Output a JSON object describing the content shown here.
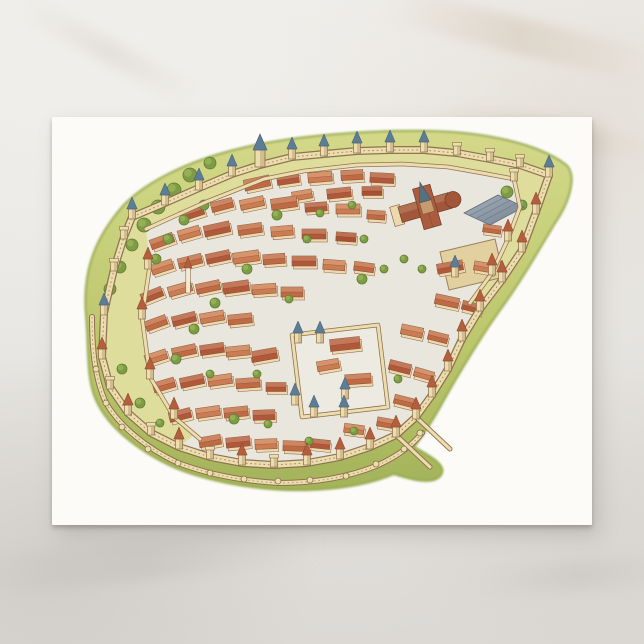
{
  "scene": {
    "description": "White postcard lying on a pale marble surface; the postcard bears a watercolor aerial illustration of a medieval walled city with towers, red-roofed houses, a cathedral and a castle",
    "signature": {
      "text": "E.",
      "x": 313,
      "y": 333
    }
  },
  "palette": {
    "postcard": "#fcfbf8",
    "street": "#e9e6dd",
    "lists": "#dcdc96",
    "grass1": "#d2d884",
    "grass2": "#b9c465",
    "grass3": "#9fb052",
    "grassEdge": "#8ea23e",
    "wallFill": "#ecdcae",
    "wallLine": "#8a6f4c",
    "houseWall": "#ecd9ad",
    "houseLine": "#8a5638",
    "roof0": "#bf6a45",
    "roof1": "#b2583a",
    "roof2": "#cb7c52",
    "roof3": "#a94f33",
    "blueRoof": "#5d7d97",
    "blueRoofDark": "#3f5a70",
    "redCone": "#b35f3d",
    "redConeDark": "#8a4228",
    "tree": "#7e9c44",
    "treeDark": "#5f7d33",
    "treeLight": "#96b458",
    "hallRib": "#6e7c89",
    "hallEdge": "#5f6d7a",
    "churchRoof": "#a2573a",
    "churchDark": "#6f3a26",
    "yard": "#e3cf9e",
    "yardLine": "#9a7c52",
    "spire": "#55707f",
    "signature": "#7a6a50",
    "castleFloor": "#edeae1"
  },
  "city": {
    "grassPath": "M34,198 C30,150 46,118 70,90 C94,64 138,44 182,33 C228,21 300,13 376,14 C434,15 486,27 513,47 C526,57 518,84 503,106 C488,131 470,163 448,193 C430,218 412,248 397,274 C386,294 376,312 362,330 C376,338 396,348 389,358 C381,369 358,362 342,357 C318,367 288,372 256,373 C213,374 165,367 126,352 C93,338 57,313 44,283 C34,261 37,229 34,198 Z",
    "ringPath": "M52,196 L62,152 L72,120 L80,100 L113,86 L147,71 L180,57 L208,48 L240,40 L272,37 L305,34 L338,33 L372,33 L405,36 L438,42 L468,48 L497,58 L484,95 L470,133 L450,163 L428,192 L410,222 L396,252 L380,278 L364,300 L344,318 L318,330 L288,340 L255,346 L222,348 L190,346 L158,340 L127,330 L99,316 L76,296 L58,270 L50,240 Z",
    "topBand": "M80,100 L113,86 L147,71 L180,57 L208,48 L240,40 L272,37 L305,34 L338,33 L372,33 L405,36 L438,42 L468,48 L462,62 L430,56 L396,50 L350,47 L305,48 L252,54 L212,62 L154,85 L94,112 Z",
    "eBand": "M468,48 L497,58 L484,95 L470,133 L450,163 L428,192 L418,186 L440,156 L456,122 L468,90 L462,62 Z",
    "wBand": "M52,196 L62,152 L72,120 L80,100 L94,112 L98,148 L90,200 L98,260 L122,300 L142,318 L127,330 L99,316 L76,296 L58,270 L50,240 Z",
    "innerTop": "M94,112 L154,85 L212,62 L252,54 L305,48 L350,47 L396,50 L430,56 L462,62",
    "innerE": "M462,62 L468,90 L456,122 L440,156 L418,186",
    "innerW": "M98,148 L90,200 L98,260 L122,300 L148,322",
    "outerSW": "M40,200 C40,238 44,264 54,286 C68,310 96,332 126,346 C158,358 192,364 226,366 C260,366 294,361 324,349 C342,341 358,331 370,316",
    "spurs": [
      "M364,300 L398,332",
      "M344,318 L378,350"
    ],
    "nubs": [
      [
        44,
        252
      ],
      [
        54,
        286
      ],
      [
        70,
        310
      ],
      [
        96,
        332
      ],
      [
        126,
        346
      ],
      [
        158,
        356
      ],
      [
        192,
        362
      ],
      [
        226,
        364
      ],
      [
        258,
        363
      ],
      [
        294,
        359
      ],
      [
        324,
        347
      ],
      [
        352,
        332
      ],
      [
        368,
        316
      ]
    ],
    "towers": [
      [
        52,
        196,
        "b"
      ],
      [
        62,
        152,
        "p"
      ],
      [
        72,
        120,
        "p"
      ],
      [
        80,
        100,
        "b"
      ],
      [
        113,
        86,
        "b"
      ],
      [
        147,
        71,
        "b"
      ],
      [
        180,
        57,
        "b"
      ],
      [
        208,
        48,
        "t"
      ],
      [
        240,
        40,
        "b"
      ],
      [
        272,
        37,
        "b"
      ],
      [
        305,
        34,
        "b"
      ],
      [
        338,
        33,
        "b"
      ],
      [
        372,
        33,
        "b"
      ],
      [
        405,
        36,
        "p"
      ],
      [
        438,
        42,
        "p"
      ],
      [
        468,
        48,
        "p"
      ],
      [
        497,
        58,
        "b"
      ],
      [
        484,
        95,
        "r"
      ],
      [
        470,
        133,
        "r"
      ],
      [
        450,
        163,
        "r"
      ],
      [
        428,
        192,
        "r"
      ],
      [
        403,
        158,
        "b"
      ],
      [
        410,
        222,
        "r"
      ],
      [
        396,
        252,
        "r"
      ],
      [
        380,
        278,
        "r"
      ],
      [
        364,
        300,
        "r"
      ],
      [
        344,
        318,
        "r"
      ],
      [
        318,
        330,
        "r"
      ],
      [
        288,
        340,
        "r"
      ],
      [
        255,
        346,
        "r"
      ],
      [
        222,
        348,
        "p"
      ],
      [
        190,
        346,
        "r"
      ],
      [
        158,
        340,
        "p"
      ],
      [
        127,
        330,
        "r"
      ],
      [
        99,
        316,
        "p"
      ],
      [
        76,
        296,
        "r"
      ],
      [
        58,
        270,
        "p"
      ],
      [
        50,
        240,
        "r"
      ],
      [
        96,
        150,
        "r"
      ],
      [
        90,
        200,
        "r"
      ],
      [
        98,
        260,
        "r"
      ],
      [
        122,
        300,
        "r"
      ],
      [
        462,
        62,
        "p"
      ],
      [
        456,
        122,
        "r"
      ],
      [
        440,
        156,
        "r"
      ]
    ],
    "houses": [
      [
        205,
        66,
        26,
        11,
        -12,
        0
      ],
      [
        236,
        62,
        22,
        10,
        -8,
        1
      ],
      [
        268,
        60,
        24,
        10,
        -5,
        2
      ],
      [
        300,
        58,
        22,
        10,
        -3,
        0
      ],
      [
        330,
        61,
        24,
        10,
        3,
        1
      ],
      [
        250,
        78,
        20,
        9,
        -10,
        2
      ],
      [
        287,
        76,
        24,
        10,
        -6,
        1
      ],
      [
        320,
        74,
        20,
        9,
        0,
        3
      ],
      [
        140,
        96,
        24,
        10,
        -18,
        1
      ],
      [
        170,
        88,
        22,
        10,
        -15,
        0
      ],
      [
        200,
        86,
        24,
        10,
        -12,
        2
      ],
      [
        232,
        86,
        26,
        11,
        -8,
        0
      ],
      [
        264,
        90,
        22,
        9,
        -4,
        1
      ],
      [
        296,
        92,
        24,
        10,
        0,
        2
      ],
      [
        324,
        98,
        18,
        9,
        4,
        0
      ],
      [
        110,
        124,
        24,
        10,
        -20,
        0
      ],
      [
        137,
        116,
        22,
        10,
        -16,
        2
      ],
      [
        165,
        112,
        26,
        11,
        -12,
        1
      ],
      [
        198,
        112,
        24,
        10,
        -8,
        0
      ],
      [
        230,
        114,
        22,
        10,
        -5,
        2
      ],
      [
        262,
        117,
        24,
        10,
        0,
        1
      ],
      [
        294,
        120,
        20,
        9,
        4,
        3
      ],
      [
        110,
        150,
        22,
        10,
        -18,
        2
      ],
      [
        138,
        144,
        24,
        10,
        -14,
        0
      ],
      [
        166,
        140,
        24,
        10,
        -12,
        1
      ],
      [
        194,
        140,
        26,
        11,
        -8,
        2
      ],
      [
        222,
        142,
        22,
        10,
        -4,
        0
      ],
      [
        252,
        144,
        24,
        10,
        0,
        1
      ],
      [
        282,
        148,
        22,
        10,
        4,
        2
      ],
      [
        312,
        150,
        20,
        9,
        8,
        0
      ],
      [
        398,
        150,
        26,
        10,
        -10,
        1
      ],
      [
        432,
        150,
        20,
        9,
        10,
        2
      ],
      [
        440,
        112,
        18,
        8,
        8,
        0
      ],
      [
        100,
        178,
        22,
        10,
        -22,
        1
      ],
      [
        128,
        172,
        24,
        10,
        -16,
        2
      ],
      [
        156,
        170,
        24,
        10,
        -12,
        0
      ],
      [
        184,
        170,
        26,
        11,
        -8,
        1
      ],
      [
        212,
        172,
        24,
        10,
        -4,
        2
      ],
      [
        240,
        175,
        22,
        10,
        0,
        0
      ],
      [
        395,
        184,
        24,
        10,
        12,
        0
      ],
      [
        420,
        190,
        20,
        9,
        14,
        1
      ],
      [
        104,
        206,
        22,
        10,
        -20,
        0
      ],
      [
        132,
        202,
        24,
        10,
        -14,
        1
      ],
      [
        160,
        200,
        24,
        10,
        -10,
        2
      ],
      [
        188,
        202,
        24,
        10,
        -6,
        0
      ],
      [
        212,
        238,
        26,
        11,
        -10,
        1
      ],
      [
        360,
        214,
        22,
        10,
        12,
        2
      ],
      [
        386,
        220,
        20,
        9,
        14,
        0
      ],
      [
        104,
        240,
        22,
        10,
        -18,
        2
      ],
      [
        132,
        234,
        24,
        10,
        -12,
        0
      ],
      [
        160,
        232,
        24,
        10,
        -8,
        1
      ],
      [
        186,
        234,
        24,
        10,
        -6,
        2
      ],
      [
        348,
        250,
        22,
        10,
        14,
        1
      ],
      [
        372,
        257,
        20,
        9,
        16,
        2
      ],
      [
        112,
        268,
        22,
        10,
        -16,
        0
      ],
      [
        140,
        264,
        24,
        10,
        -12,
        1
      ],
      [
        168,
        263,
        24,
        10,
        -8,
        2
      ],
      [
        196,
        266,
        24,
        10,
        -4,
        0
      ],
      [
        224,
        270,
        20,
        9,
        0,
        1
      ],
      [
        352,
        284,
        20,
        9,
        14,
        0
      ],
      [
        128,
        298,
        22,
        10,
        -14,
        1
      ],
      [
        156,
        295,
        24,
        10,
        -8,
        2
      ],
      [
        184,
        295,
        24,
        10,
        -6,
        0
      ],
      [
        212,
        298,
        22,
        10,
        -2,
        1
      ],
      [
        302,
        312,
        20,
        9,
        8,
        2
      ],
      [
        335,
        306,
        20,
        9,
        10,
        0
      ],
      [
        158,
        324,
        22,
        10,
        -10,
        0
      ],
      [
        186,
        325,
        24,
        10,
        -6,
        1
      ],
      [
        214,
        327,
        22,
        10,
        -2,
        2
      ],
      [
        242,
        329,
        22,
        10,
        2,
        0
      ],
      [
        268,
        327,
        20,
        9,
        6,
        1
      ]
    ],
    "trees": [
      [
        138,
        58,
        7
      ],
      [
        122,
        73,
        7
      ],
      [
        106,
        90,
        7
      ],
      [
        92,
        108,
        7
      ],
      [
        80,
        128,
        6
      ],
      [
        68,
        150,
        6
      ],
      [
        58,
        172,
        6
      ],
      [
        158,
        46,
        6
      ],
      [
        152,
        88,
        5
      ],
      [
        132,
        103,
        5
      ],
      [
        116,
        122,
        5
      ],
      [
        104,
        142,
        5
      ],
      [
        225,
        98,
        5
      ],
      [
        255,
        122,
        4
      ],
      [
        195,
        152,
        5
      ],
      [
        163,
        186,
        5
      ],
      [
        142,
        212,
        5
      ],
      [
        124,
        242,
        5
      ],
      [
        158,
        257,
        4
      ],
      [
        205,
        257,
        4
      ],
      [
        237,
        182,
        4
      ],
      [
        310,
        162,
        5
      ],
      [
        352,
        142,
        4
      ],
      [
        312,
        122,
        4
      ],
      [
        332,
        152,
        4
      ],
      [
        370,
        152,
        4
      ],
      [
        182,
        302,
        5
      ],
      [
        216,
        307,
        4
      ],
      [
        257,
        324,
        4
      ],
      [
        302,
        314,
        4
      ],
      [
        346,
        262,
        4
      ],
      [
        455,
        75,
        6
      ],
      [
        470,
        88,
        5
      ],
      [
        300,
        88,
        4
      ],
      [
        268,
        96,
        4
      ],
      [
        70,
        252,
        5
      ],
      [
        88,
        286,
        5
      ],
      [
        108,
        306,
        4
      ],
      [
        265,
        263,
        9
      ]
    ],
    "church": {
      "x": 375,
      "y": 90,
      "rot": -16
    },
    "hall": {
      "path": "M412,96 L446,78 L472,90 L438,108 Z",
      "ribs": [
        [
          418,
          98.5,
          452,
          80.5
        ],
        [
          425,
          101,
          459,
          83
        ],
        [
          432,
          103.5,
          466,
          85.5
        ]
      ]
    },
    "eYard": "M388,135 L443,122 L452,160 L397,173 Z",
    "castle": {
      "yard": "M240,218 L326,208 L336,290 L250,300 Z",
      "houses": [
        [
          293,
          227,
          30,
          12,
          -6,
          1
        ],
        [
          276,
          248,
          22,
          10,
          -10,
          2
        ],
        [
          306,
          262,
          26,
          10,
          -4,
          0
        ]
      ],
      "towers": [
        [
          246,
          224
        ],
        [
          268,
          224
        ],
        [
          293,
          280
        ],
        [
          243,
          286
        ],
        [
          262,
          298
        ],
        [
          292,
          298
        ]
      ]
    },
    "minaret": {
      "x": 136,
      "y": 145
    }
  }
}
